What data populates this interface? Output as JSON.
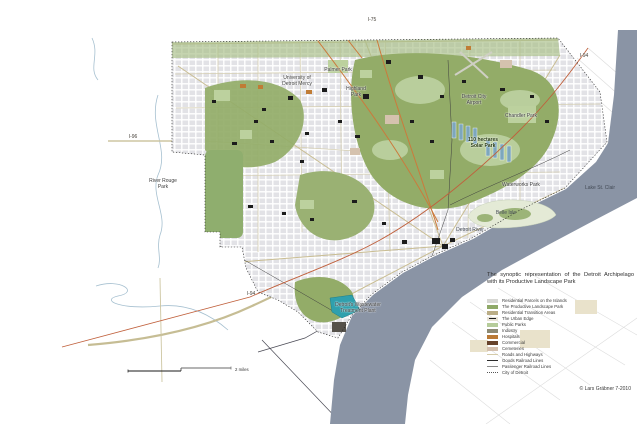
{
  "title": "The synoptic representation of the Detroit Archipelago with its Productive Landscape Park",
  "credit": "© Lars Gräbner 7-2010",
  "scale_bar": {
    "label": "2 miles"
  },
  "map": {
    "labels": {
      "i75": {
        "text": "I-75"
      },
      "i94_ne": {
        "text": "I-94"
      },
      "i96": {
        "text": "I-96"
      },
      "i94_sw": {
        "text": "I-94"
      },
      "river_rouge": {
        "text": "River Rouge\nPark"
      },
      "university": {
        "text": "University of\nDetroit Mercy"
      },
      "palmer_park": {
        "text": "Palmer Park"
      },
      "highland_park": {
        "text": "Highland\nPark"
      },
      "airport": {
        "text": "Detroit City\nAirport"
      },
      "chandler_park": {
        "text": "Chandler Park"
      },
      "solar_park": {
        "text": "110 hectares\nSolar Park"
      },
      "waterworks": {
        "text": "Waterworks Park"
      },
      "belle_isle": {
        "text": "Belle Isle"
      },
      "detroit_river": {
        "text": "Detroit River"
      },
      "lake_st_clair": {
        "text": "Lake St. Clair"
      },
      "wastewater": {
        "text": "Detroit's Wastewater\nTreatment Plant"
      }
    }
  },
  "legend": {
    "items": [
      {
        "label": "Residential Parcels on the Islands",
        "color": "#d7d7d3",
        "swatch": "area"
      },
      {
        "label": "The Productive Landscape Park",
        "color": "#8fa968",
        "swatch": "area"
      },
      {
        "label": "Residential Transition Areas",
        "color": "#cbbf98",
        "swatch": "area-speckled"
      },
      {
        "label": "The Urban Edge",
        "color": "#e8e3d6",
        "swatch": "area-edge-symbol"
      },
      {
        "label": "Public Parks",
        "color": "#b6cc9a",
        "swatch": "area"
      },
      {
        "label": "Industry",
        "color": "#8d8a74",
        "swatch": "area"
      },
      {
        "label": "Hospitals",
        "color": "#ba7a36",
        "swatch": "area"
      },
      {
        "label": "Commercial",
        "color": "#67432b",
        "swatch": "area"
      },
      {
        "label": "Cemeteries",
        "color": "#d4c0ae",
        "swatch": "area"
      },
      {
        "label": "Roads and Highways",
        "color": "#d5cba8",
        "swatch": "line"
      },
      {
        "label": "Goods Railroad Lines",
        "color": "#2c2c2c",
        "swatch": "line"
      },
      {
        "label": "Passenger Railroad Lines",
        "color": "#8a8a8a",
        "swatch": "line"
      },
      {
        "label": "City of Detroit",
        "color": "#555555",
        "swatch": "dotted-line"
      }
    ]
  }
}
